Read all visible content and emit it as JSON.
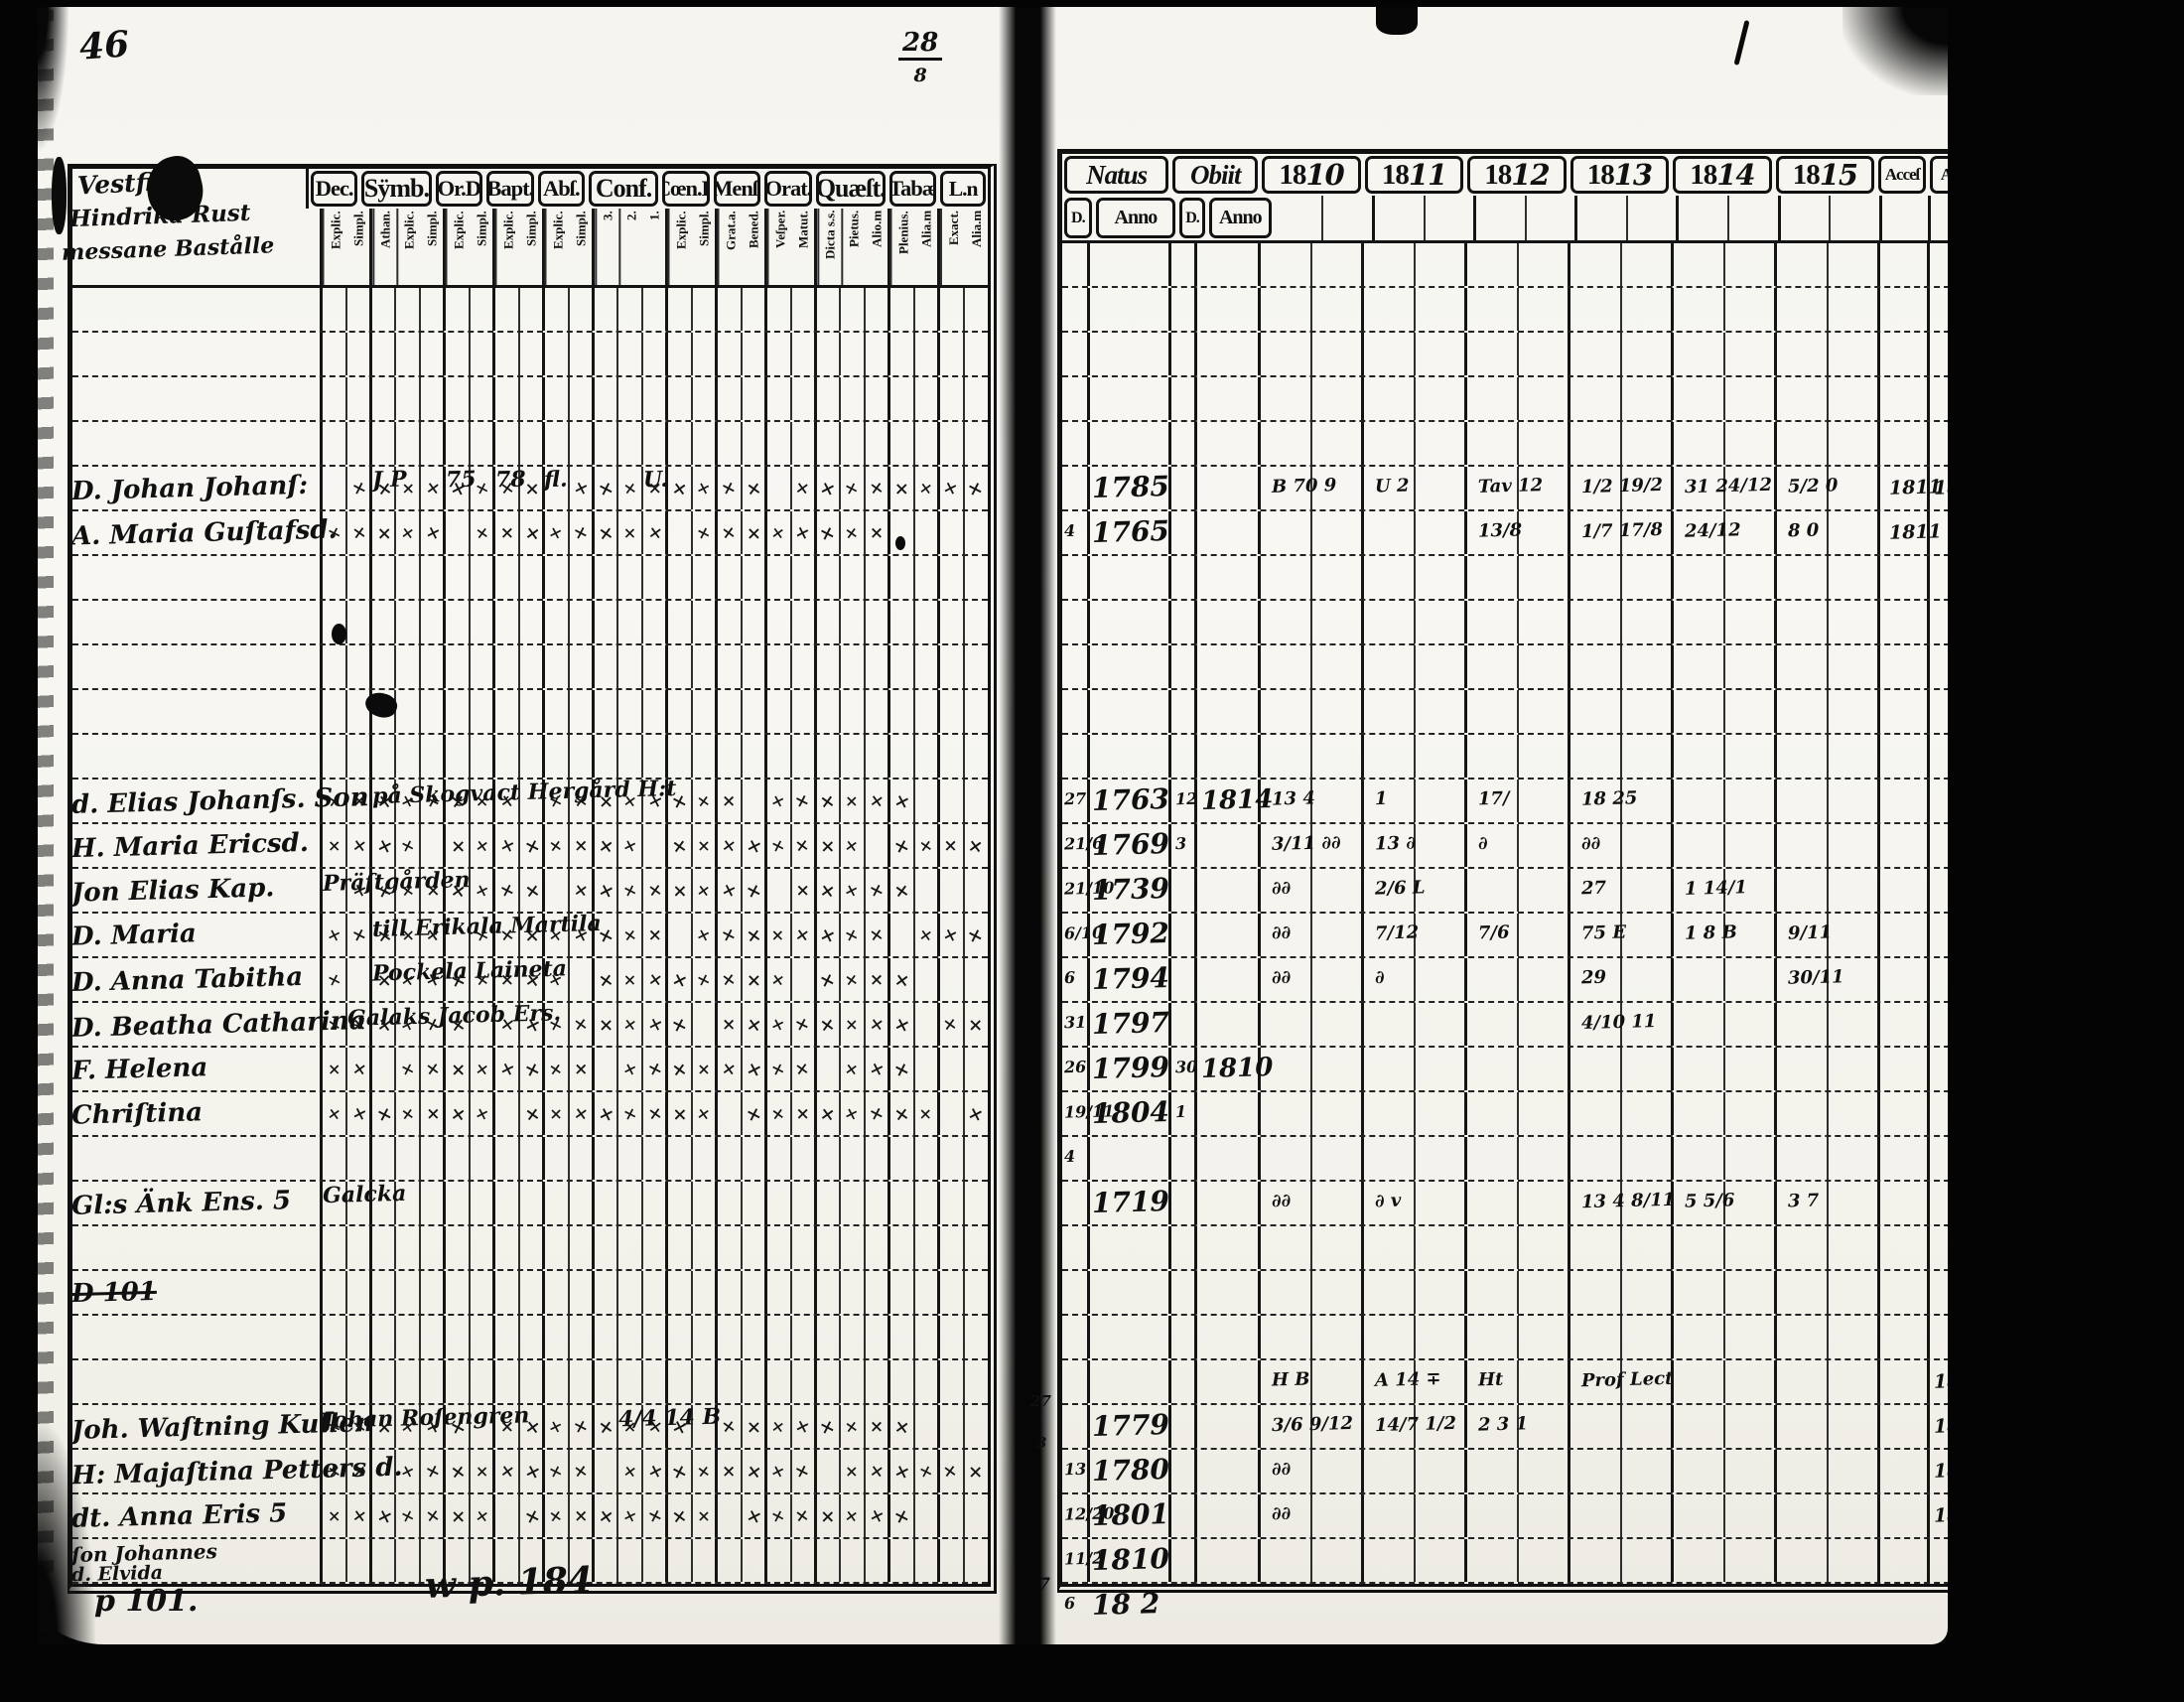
{
  "annotations": {
    "page_number": "46",
    "folio_fraction_top": "28",
    "folio_fraction_bottom": "8",
    "bottom_note_left": "p 101.",
    "bottom_note_center": "w p. 184",
    "right_margin_notes": [
      "27",
      "3",
      "7"
    ]
  },
  "left_page": {
    "heading": [
      "Vestfila",
      "Hindrika Rust",
      "messane Bastålle"
    ],
    "columns": [
      {
        "label": "Dec.",
        "sub": [
          "Explic.",
          "Simpl."
        ]
      },
      {
        "label": "Sÿmb.",
        "sub": [
          "Athan.",
          "Explic.",
          "Simpl."
        ]
      },
      {
        "label": "Or.D",
        "sub": [
          "Explic.",
          "Simpl."
        ]
      },
      {
        "label": "Bapt.",
        "sub": [
          "Explic.",
          "Simpl."
        ]
      },
      {
        "label": "Abſ.",
        "sub": [
          "Explic.",
          "Simpl."
        ]
      },
      {
        "label": "Conf.",
        "sub": [
          "3.",
          "2.",
          "1."
        ]
      },
      {
        "label": "Cœn.D",
        "sub": [
          "Explic.",
          "Simpl."
        ]
      },
      {
        "label": "Menſ.",
        "sub": [
          "Grat.a.",
          "Bened."
        ]
      },
      {
        "label": "Orat.",
        "sub": [
          "Veſper.",
          "Matut."
        ]
      },
      {
        "label": "Quæſt.",
        "sub": [
          "Dicta s.s.",
          "Pietus.",
          "Alio.m"
        ]
      },
      {
        "label": "Tabæ",
        "sub": [
          "Plenius.",
          "Alia.m"
        ]
      },
      {
        "label": "L.n",
        "sub": [
          "Exact.",
          "Alia.m"
        ]
      }
    ],
    "row_count": 29,
    "entries": [
      {
        "row": 4,
        "name": "D. Johan Johanſ:",
        "marks": true,
        "notes": [
          {
            "slot": 2,
            "text": "J P"
          },
          {
            "slot": 5,
            "text": "75"
          },
          {
            "slot": 7,
            "text": "78"
          },
          {
            "slot": 9,
            "text": "fl."
          },
          {
            "slot": 13,
            "text": "U."
          }
        ]
      },
      {
        "row": 5,
        "name": "A. Maria Guſtafsd.",
        "marks": true
      },
      {
        "row": 11,
        "name": "d. Elias Johanſs. Son",
        "marks": true,
        "notes": [
          {
            "slot": 2,
            "text": "på Skogvact Hergård H:t"
          }
        ]
      },
      {
        "row": 12,
        "name": "H. Maria Ericsd.",
        "marks": true
      },
      {
        "row": 13,
        "name": "Jon Elias  Kap.",
        "marks": true,
        "notes": [
          {
            "slot": 0,
            "text": "Präſtgården"
          }
        ]
      },
      {
        "row": 14,
        "name": "D. Maria",
        "marks": true,
        "notes": [
          {
            "slot": 2,
            "text": "till Erikala Martila"
          }
        ]
      },
      {
        "row": 15,
        "name": "D. Anna Tabitha",
        "marks": true,
        "notes": [
          {
            "slot": 2,
            "text": "Pockela Laineta"
          }
        ]
      },
      {
        "row": 16,
        "name": "D. Beatha Catharina",
        "marks": true,
        "notes": [
          {
            "slot": 1,
            "text": "Galaks Jacob Ers."
          }
        ]
      },
      {
        "row": 17,
        "name": "F. Helena",
        "marks": true
      },
      {
        "row": 18,
        "name": "Chriſtina",
        "marks": true
      },
      {
        "row": 20,
        "name": "Gl:s Änk Ens. 5",
        "notes": [
          {
            "slot": 0,
            "text": "Galcka"
          }
        ]
      },
      {
        "row": 22,
        "name": "D 101",
        "strike": true
      },
      {
        "row": 25,
        "name": "Joh. Waſtning Kullen",
        "marks": true,
        "notes": [
          {
            "slot": 0,
            "text": "Johan Roſengren"
          },
          {
            "slot": 12,
            "text": "4/4 14 B"
          }
        ]
      },
      {
        "row": 26,
        "name": "H: Majaſtina Petters d.",
        "marks": true
      },
      {
        "row": 27,
        "name": "dt. Anna Eris 5",
        "marks": true
      },
      {
        "row": 28,
        "name": "ſon Johannes",
        "name2": "d. Elvida"
      }
    ]
  },
  "right_page": {
    "natus_label": "Natus",
    "obiit_label": "Obiit",
    "day_label": "D.",
    "anno_label": "Anno",
    "year_labels": [
      "1810",
      "1811",
      "1812",
      "1813",
      "1814",
      "1815"
    ],
    "acce_label": "Acceſ",
    "abs_label": "Abſ.",
    "row_count": 30,
    "entries": [
      {
        "row": 4,
        "anno": "1785",
        "years": [
          "B 70 9",
          "U 2",
          "Tav 12",
          "1/2 19/2",
          "31 24/12",
          "5/2 0"
        ],
        "acce": "1811",
        "abs": "1815"
      },
      {
        "row": 5,
        "d": "4",
        "anno": "1765",
        "years": [
          "",
          "",
          "13/8",
          "1/7 17/8",
          "24/12",
          "8 0"
        ],
        "acce": "1811"
      },
      {
        "row": 11,
        "d": "27",
        "anno": "1763",
        "od": "12",
        "oa": "1814",
        "years": [
          "13 4",
          "1",
          "17/",
          "18 25",
          "",
          ""
        ]
      },
      {
        "row": 12,
        "d": "21/6",
        "anno": "1769",
        "od": "3",
        "years": [
          "3/11 ∂∂",
          "13 ∂",
          "∂",
          "∂∂",
          "",
          ""
        ]
      },
      {
        "row": 13,
        "d": "21/10",
        "anno": "1739",
        "years": [
          "∂∂",
          "2/6 L",
          "",
          "27",
          "1 14/1",
          ""
        ]
      },
      {
        "row": 14,
        "d": "6/10",
        "anno": "1792",
        "years": [
          "∂∂",
          "7/12",
          "7/6",
          "75 E",
          "1 8 B",
          "9/11"
        ]
      },
      {
        "row": 15,
        "d": "6",
        "anno": "1794",
        "years": [
          "∂∂",
          "∂",
          "",
          "29",
          "",
          "30/11"
        ]
      },
      {
        "row": 16,
        "d": "31",
        "anno": "1797",
        "years": [
          "",
          "",
          "",
          "4/10 11",
          "",
          ""
        ]
      },
      {
        "row": 17,
        "d": "26",
        "anno": "1799",
        "od": "30",
        "oa": "1810"
      },
      {
        "row": 18,
        "d": "19/11",
        "anno": "1804",
        "od": "1"
      },
      {
        "row": 19,
        "d": "4"
      },
      {
        "row": 20,
        "anno": "1719",
        "years": [
          "∂∂",
          "∂ v",
          "",
          "13 4 8/11",
          "5 5/6",
          "3 7"
        ]
      },
      {
        "row": 24,
        "years": [
          "H B",
          "A 14 ∓",
          "Ht",
          "Prof Lect",
          "",
          ""
        ],
        "abs": "1812"
      },
      {
        "row": 25,
        "anno": "1779",
        "years": [
          "3/6 9/12",
          "14/7 1/2",
          "2 3 1",
          "",
          "",
          ""
        ],
        "abs": "1814"
      },
      {
        "row": 26,
        "d": "13",
        "anno": "1780",
        "years": [
          "∂∂",
          "",
          "",
          "",
          "",
          ""
        ],
        "abs": "1814"
      },
      {
        "row": 27,
        "d": "12/20",
        "anno": "1801",
        "years": [
          "∂∂",
          "",
          "",
          "",
          "",
          ""
        ],
        "abs": "18 4"
      },
      {
        "row": 28,
        "d": "11/2",
        "anno": "1810"
      },
      {
        "row": 29,
        "d": "6",
        "anno": "18 2"
      }
    ]
  }
}
